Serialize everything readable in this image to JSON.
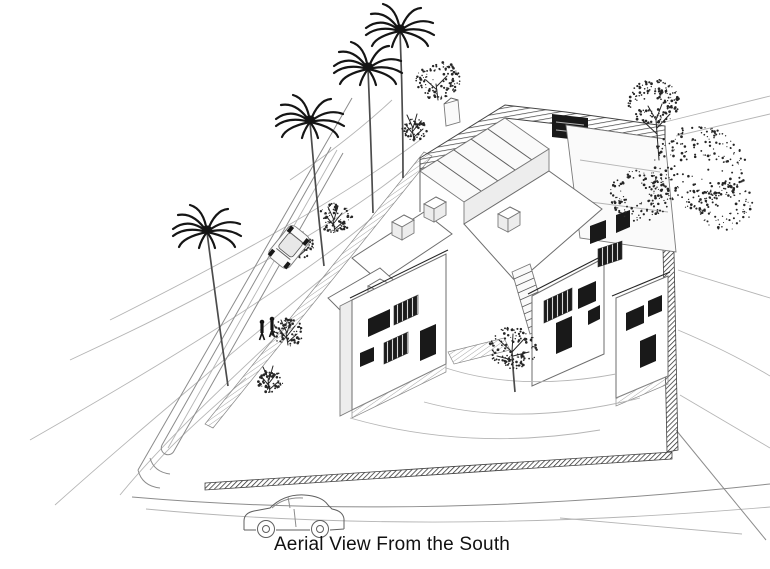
{
  "caption": {
    "text": "Aerial View From the South"
  },
  "palette": {
    "paper": "#ffffff",
    "ink": "#262626",
    "pencil": "#8c8c8c",
    "light_pencil": "#b5b5b5"
  },
  "scene": {
    "type": "hand-drawn architectural perspective sketch",
    "subject": "courtyard housing complex seen from the air",
    "palm_tree_count": 4,
    "pedestrian_count": 2,
    "car_count": 2
  }
}
